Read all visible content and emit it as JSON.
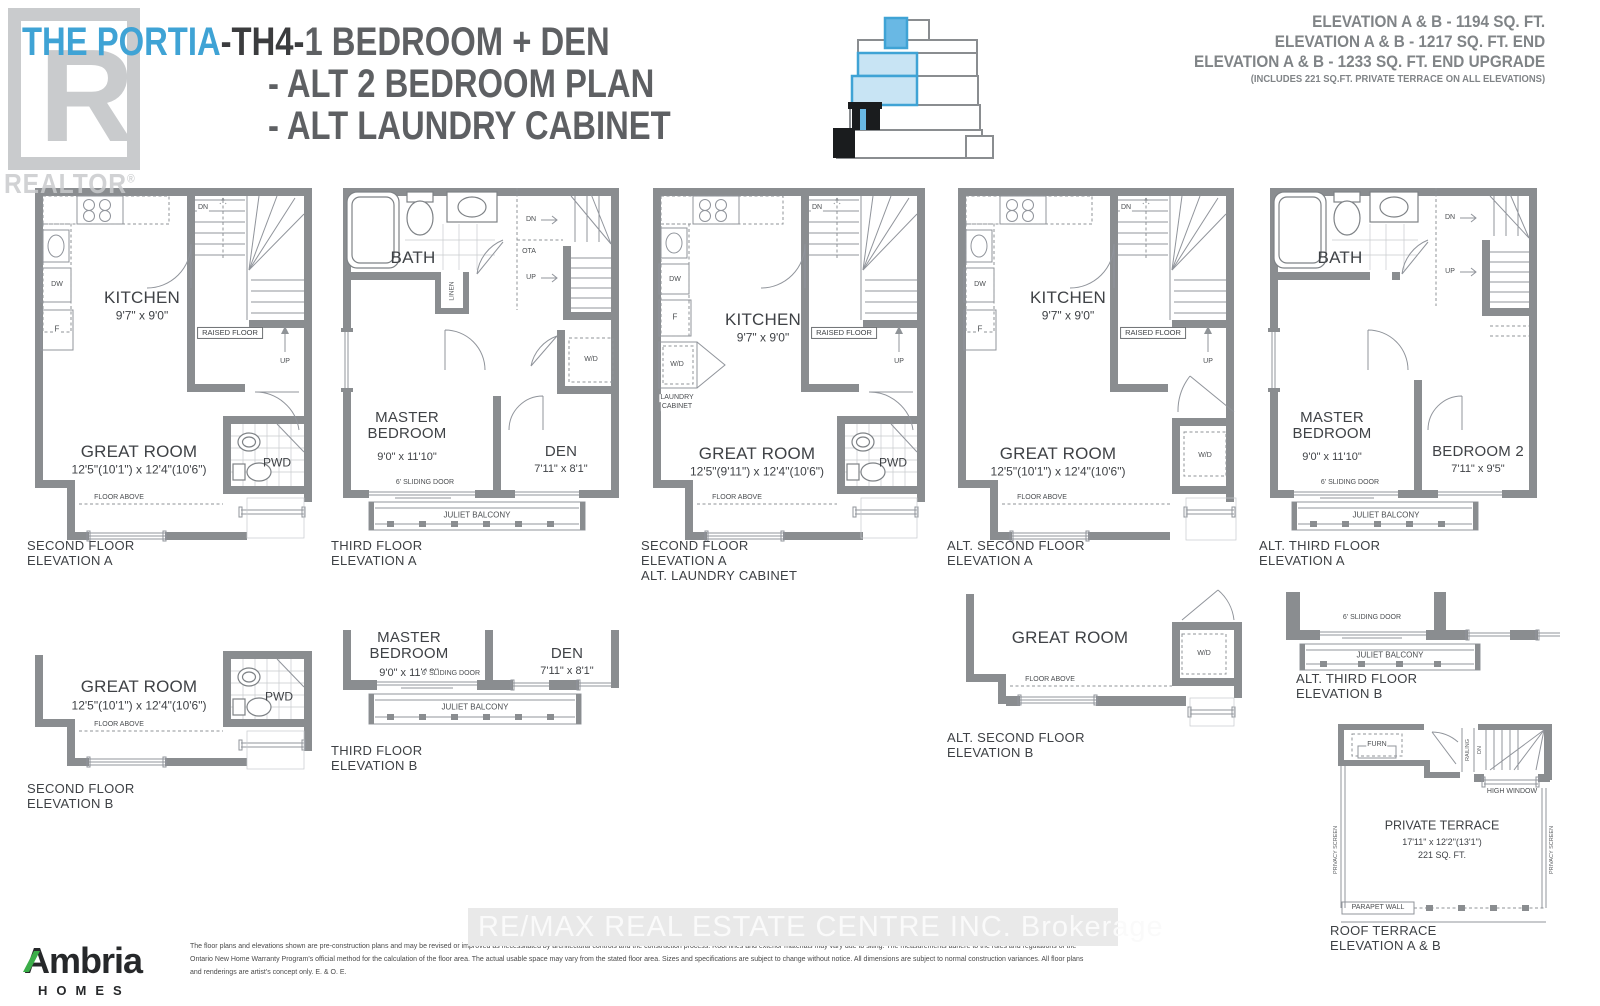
{
  "header": {
    "brand": "THE PORTIA",
    "model": "-TH4-",
    "features": [
      "1 BEDROOM + DEN",
      "- ALT 2 BEDROOM PLAN",
      "- ALT LAUNDRY CABINET"
    ],
    "realtor": {
      "letter": "R",
      "label": "REALTOR",
      "reg": "®"
    }
  },
  "elevation_summary": {
    "lines": [
      "ELEVATION A & B - 1194  SQ. FT.",
      "ELEVATION A & B - 1217 SQ. FT. END",
      "ELEVATION A & B - 1233 SQ. FT. END UPGRADE"
    ],
    "note": "(INCLUDES 221 SQ.FT. PRIVATE TERRACE ON ALL ELEVATIONS)"
  },
  "plans": [
    {
      "caption": [
        "SECOND FLOOR",
        "ELEVATION A"
      ],
      "texts": {
        "room1": "KITCHEN",
        "room1_dims": "9'7\" x 9'0\"",
        "room2": "GREAT ROOM",
        "room2_dims": "12'5\"(10'1\") x 12'4\"(10'6\")",
        "pwd": "PWD",
        "raised_floor": "RAISED FLOOR",
        "floor_above": "FLOOR ABOVE",
        "dw": "DW",
        "f": "F",
        "dn": "DN",
        "up": "UP"
      }
    },
    {
      "caption": [
        "THIRD FLOOR",
        "ELEVATION A"
      ],
      "texts": {
        "bath": "BATH",
        "linen": "LINEN",
        "dn": "DN",
        "ota": "OTA",
        "up": "UP",
        "wd": "W/D",
        "room1": "MASTER BEDROOM",
        "room1_dims": "9'0\" x 11'10\"",
        "room2": "DEN",
        "room2_dims": "7'11\" x 8'1\"",
        "sliding": "6' SLIDING DOOR",
        "juliet": "JULIET BALCONY"
      }
    },
    {
      "caption": [
        "SECOND FLOOR",
        "ELEVATION A",
        "ALT. LAUNDRY CABINET"
      ],
      "texts": {
        "room1": "KITCHEN",
        "room1_dims": "9'7\" x 9'0\"",
        "room2": "GREAT ROOM",
        "room2_dims": "12'5\"(9'11\") x 12'4\"(10'6\")",
        "pwd": "PWD",
        "raised_floor": "RAISED FLOOR",
        "floor_above": "FLOOR ABOVE",
        "dw": "DW",
        "f": "F",
        "wd": "W/D",
        "laundry1": "LAUNDRY",
        "laundry2": "CABINET",
        "dn": "DN",
        "up": "UP"
      }
    },
    {
      "caption": [
        "ALT. SECOND FLOOR",
        "ELEVATION A"
      ],
      "texts": {
        "room1": "KITCHEN",
        "room1_dims": "9'7\" x 9'0\"",
        "room2": "GREAT ROOM",
        "room2_dims": "12'5\"(10'1\") x 12'4\"(10'6\")",
        "wd": "W/D",
        "raised_floor": "RAISED FLOOR",
        "floor_above": "FLOOR ABOVE",
        "dw": "DW",
        "f": "F",
        "dn": "DN",
        "up": "UP"
      }
    },
    {
      "caption": [
        "ALT. THIRD FLOOR",
        "ELEVATION A"
      ],
      "texts": {
        "bath": "BATH",
        "dn": "DN",
        "up": "UP",
        "room1": "MASTER BEDROOM",
        "room1_dims": "9'0\" x 11'10\"",
        "room2": "BEDROOM 2",
        "room2_dims": "7'11\" x 9'5\"",
        "sliding": "6' SLIDING DOOR",
        "juliet": "JULIET BALCONY"
      }
    },
    {
      "caption": [
        "SECOND FLOOR",
        "ELEVATION B"
      ],
      "texts": {
        "room": "GREAT ROOM",
        "dims": "12'5\"(10'1\") x 12'4\"(10'6\")",
        "floor_above": "FLOOR ABOVE",
        "pwd": "PWD"
      }
    },
    {
      "caption": [
        "THIRD FLOOR",
        "ELEVATION B"
      ],
      "texts": {
        "room1": "MASTER BEDROOM",
        "room1_dims": "9'0\" x 11'10\"",
        "room2": "DEN",
        "room2_dims": "7'11\" x 8'1\"",
        "sliding": "6' SLIDING DOOR",
        "juliet": "JULIET BALCONY"
      }
    },
    {
      "caption": [
        "ALT. SECOND FLOOR",
        "ELEVATION B"
      ],
      "texts": {
        "room": "GREAT ROOM",
        "floor_above": "FLOOR ABOVE",
        "wd": "W/D"
      }
    },
    {
      "caption": [
        "ALT. THIRD FLOOR",
        "ELEVATION B"
      ],
      "texts": {
        "sliding": "6' SLIDING DOOR",
        "juliet": "JULIET BALCONY"
      }
    },
    {
      "caption": [
        "ROOF TERRACE",
        "ELEVATION A & B"
      ],
      "texts": {
        "room": "PRIVATE TERRACE",
        "dims": "17'11\" x 12'2\"(13'1\")",
        "area": "221 SQ. FT.",
        "furn": "FURN",
        "railing": "RAILING",
        "dn": "DN",
        "high_window": "HIGH WINDOW",
        "privacy": "PRIVACY SCREEN",
        "parapet": "PARAPET WALL"
      }
    }
  ],
  "footer": {
    "builder": {
      "name": "Ambria",
      "sub": "HOMES"
    },
    "disclaimer": [
      "The floor plans and elevations shown are pre-construction plans and may be revised or improved as necessitated by architectural controls and the construction process. Roof lines and exterior materials may vary due to siting. The measurements adhere to the rules and regulations of the",
      "Ontario New Home Warranty Program's official method for the calculation of the floor area. The actual usable space may vary from the stated floor area. Sizes and specifications are subject to change without notice. All dimensions are subject to normal construction variances. All floor plans",
      "and renderings are artist's concept only. E. & O. E."
    ]
  },
  "watermark": {
    "text": "RE/MAX REAL ESTATE CENTRE INC.  Brokerage"
  },
  "colors": {
    "accent_blue": "#3FA3D5",
    "light_blue": "#C8E4F4",
    "wall_gray": "#8A8D90",
    "text_dark": "#3F4246",
    "green": "#3BAE49"
  }
}
